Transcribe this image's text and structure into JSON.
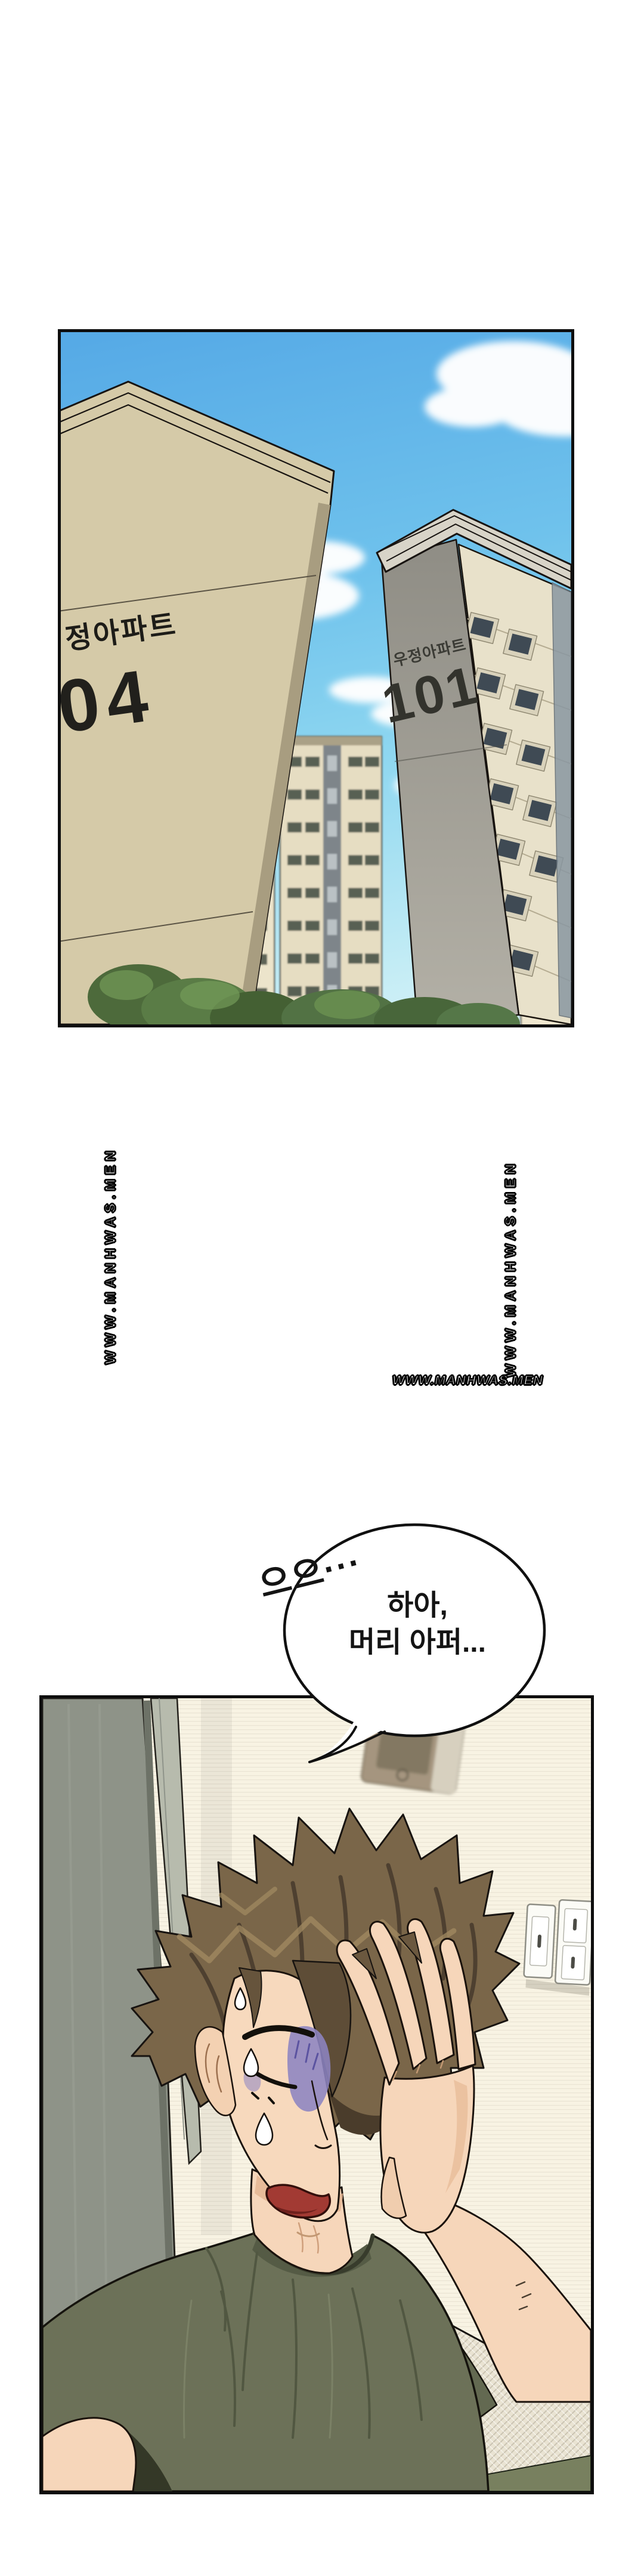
{
  "page": {
    "background": "#ffffff"
  },
  "city_panel": {
    "sky_colors": {
      "top": "#55a9e6",
      "mid": "#7ccbee",
      "bottom": "#d9f3f7"
    },
    "left_building": {
      "name_label": "정아파트",
      "number": "04"
    },
    "right_building": {
      "name_label": "우정아파트",
      "number": "101"
    },
    "mid_building": {
      "number": "102"
    }
  },
  "watermark": {
    "text": "WWW.MANHWAS.MEN"
  },
  "sfx": {
    "groan": "으으···"
  },
  "speech_bubble": {
    "line1": "하아,",
    "line2": "머리 아퍼..."
  },
  "room_panel": {
    "colors": {
      "wall": "#f8f3e3",
      "door": "#8e9388",
      "shirt": "#6c7158",
      "hair": "#7a6649",
      "skin": "#f6d6ba",
      "bruise": "#8d84c2"
    }
  }
}
